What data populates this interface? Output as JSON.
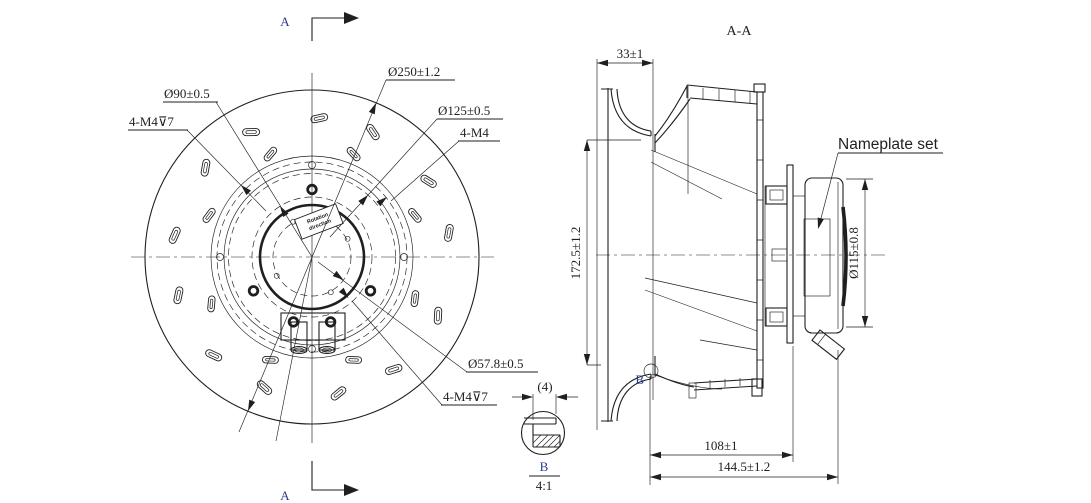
{
  "colors": {
    "ink": "#1f1f1f",
    "marker_blue": "#2c3a8f",
    "background": "#ffffff"
  },
  "front_view": {
    "section_marker": "A",
    "labels": {
      "d250": "Ø250±1.2",
      "d125": "Ø125±0.5",
      "m4": "4-M4",
      "d90": "Ø90±0.5",
      "m4_depth": "4-M4⊽7",
      "d578": "Ø57.8±0.5"
    },
    "center_label": {
      "line1": "Rotation",
      "line2": "direction"
    }
  },
  "section_view": {
    "title": "A-A",
    "dims": {
      "inlet_width": "33±1",
      "impeller_height": "172.5±1.2",
      "motor_dia": "Ø115±0.8",
      "body_depth": "108±1",
      "total_depth": "144.5±1.2"
    },
    "nameplate_label": "Nameplate set",
    "detail_marker": "B"
  },
  "detail_view": {
    "dim": "(4)",
    "letter": "B",
    "scale": "4:1"
  }
}
